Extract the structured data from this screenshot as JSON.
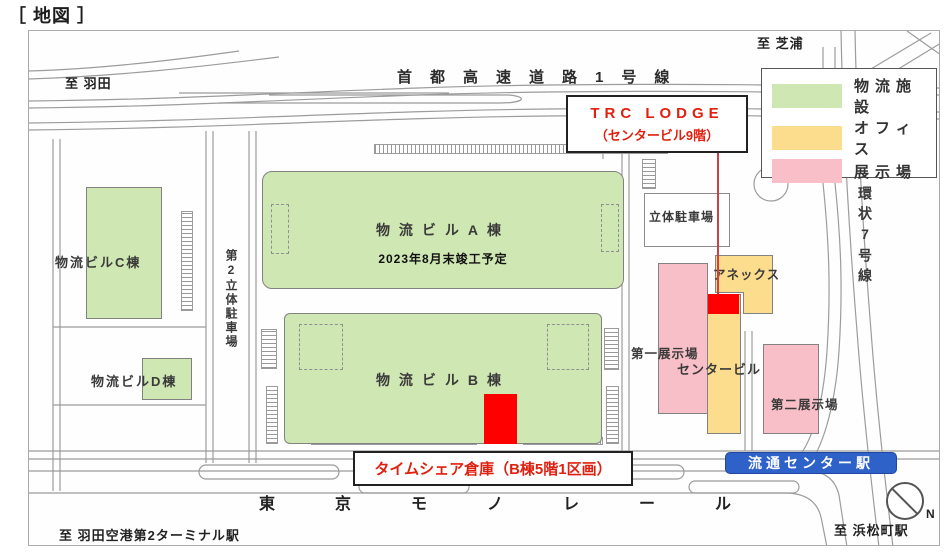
{
  "title": "［ 地図 ］",
  "roads": {
    "expressway": "首都高速道路1号線",
    "ring_road": "環状7号線",
    "monorail": "東京モノレール"
  },
  "directions": {
    "to_haneda": "至 羽田",
    "to_shibaura": "至 芝浦",
    "to_haneda_airport": "至 羽田空港第2ターミナル駅",
    "to_hamamatsucho": "至 浜松町駅",
    "north": "N"
  },
  "legend": {
    "items": [
      {
        "label": "物流施設",
        "color": "#cfe7b2"
      },
      {
        "label": "オフィス",
        "color": "#fbdd8d"
      },
      {
        "label": "展示場",
        "color": "#f9bfc8"
      }
    ]
  },
  "buildings": {
    "bldg_a": {
      "name": "物流ビルA棟",
      "note": "2023年8月末竣工予定"
    },
    "bldg_b": {
      "name": "物流ビルB棟"
    },
    "bldg_c": {
      "name": "物流ビルC棟"
    },
    "bldg_d": {
      "name": "物流ビルD棟"
    },
    "center_bldg": {
      "name": "センタービル"
    },
    "annex": {
      "name": "アネックス"
    },
    "exhibition1": {
      "name": "第一展示場"
    },
    "exhibition2": {
      "name": "第二展示場"
    },
    "parking1": {
      "name": "立体駐車場"
    },
    "parking2": {
      "name": "第2立体駐車場"
    }
  },
  "annotations": {
    "trc_lodge_line1": "TRC LODGE",
    "trc_lodge_line2": "（センタービル9階）",
    "timeshare": "タイムシェア倉庫（B棟5階1区画）"
  },
  "station": {
    "name": "流通センター駅"
  },
  "colors": {
    "logistics_green": "#cfe7b2",
    "office_yellow": "#fbdd8d",
    "exhibition_pink": "#f9bfc8",
    "marker_red": "#fe0000",
    "station_blue": "#2e62c8",
    "annotation_red": "#e02010"
  }
}
